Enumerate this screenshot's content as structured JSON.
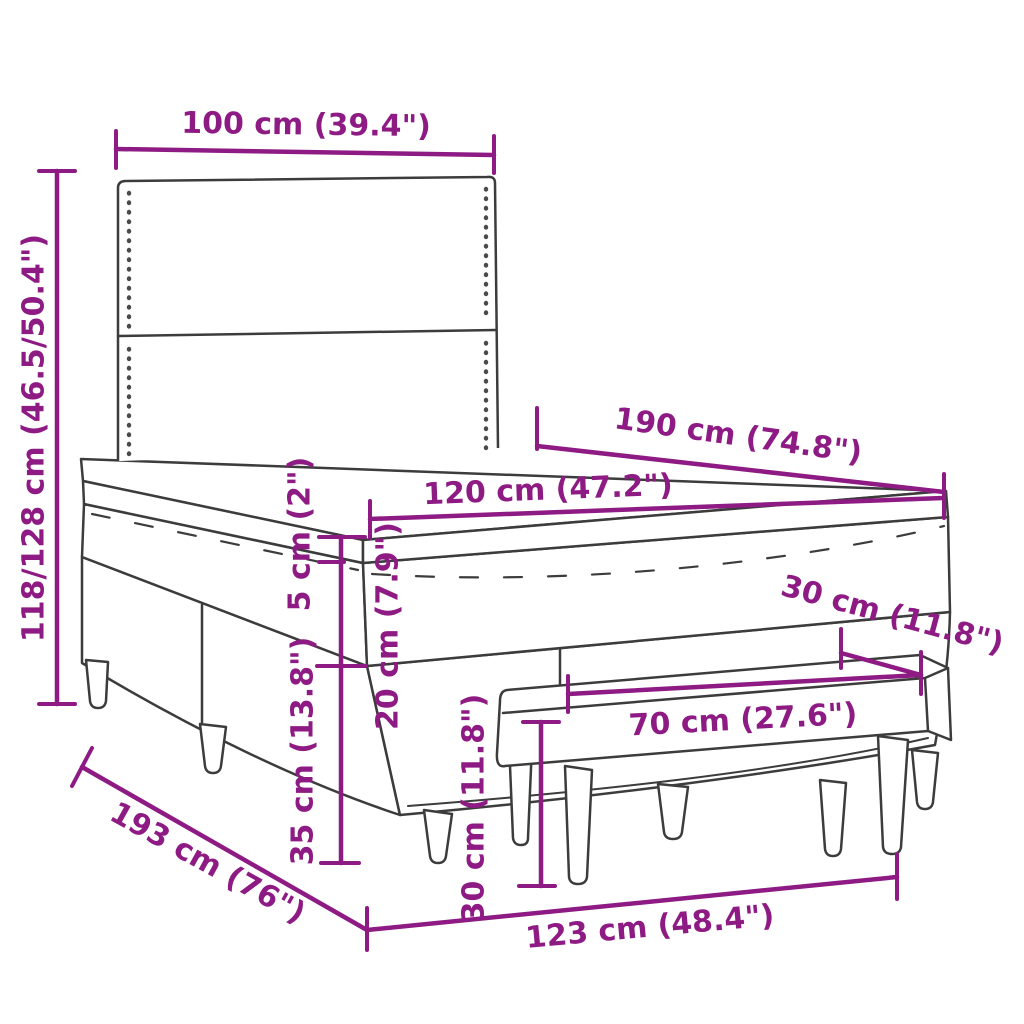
{
  "figure": {
    "type": "product-dimension-diagram",
    "subject": "box spring bed with headboard, mattress topper and bench"
  },
  "colors": {
    "dimension_accent": "#8E1A84",
    "line_art": "#3C3C3C",
    "background": "#FFFFFF"
  },
  "dimensions": {
    "headboard_width": {
      "label": "100 cm (39.4\")"
    },
    "total_height": {
      "label": "118/128 cm (46.5/50.4\")"
    },
    "bed_length": {
      "label": "190 cm (74.8\")"
    },
    "bed_width": {
      "label": "120 cm (47.2\")"
    },
    "topper_height": {
      "label": "5 cm (2\")"
    },
    "mattress_height": {
      "label": "20 cm (7.9\")"
    },
    "box_height": {
      "label": "35 cm (13.8\")"
    },
    "bench_depth": {
      "label": "30 cm (11.8\")"
    },
    "bench_width": {
      "label": "70 cm (27.6\")"
    },
    "bench_height": {
      "label": "30 cm (11.8\")"
    },
    "frame_length": {
      "label": "193 cm (76\")"
    },
    "frame_width": {
      "label": "123 cm (48.4\")"
    }
  }
}
